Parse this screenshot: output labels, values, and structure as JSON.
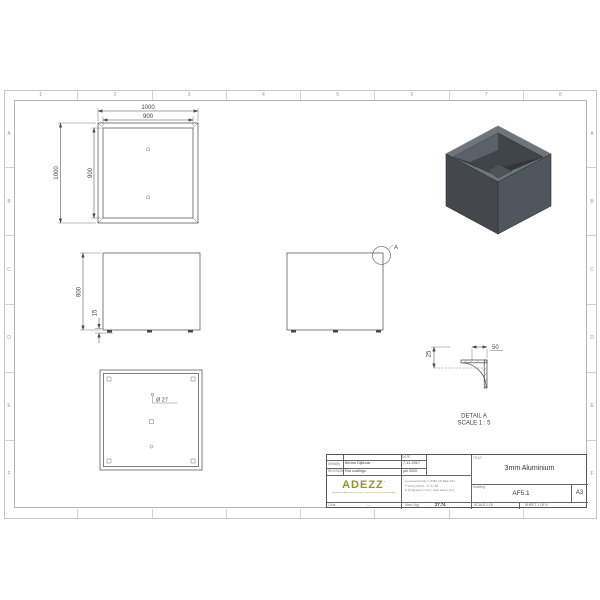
{
  "sheet": {
    "grid_columns": [
      "1",
      "2",
      "3",
      "4",
      "5",
      "6",
      "7",
      "8"
    ],
    "grid_rows": [
      "A",
      "B",
      "C",
      "D",
      "E",
      "F"
    ]
  },
  "views": {
    "top": {
      "dim_width_outer": "1000",
      "dim_width_inner": "900",
      "dim_height_outer": "1000",
      "dim_height_inner": "900"
    },
    "front": {
      "dim_height": "800",
      "dim_foot": "15"
    },
    "side": {
      "detail_label": "A"
    },
    "bottom": {
      "hole_dia": "Ø 27"
    },
    "detail": {
      "title": "DETAIL A",
      "scale": "SCALE 1 : 5",
      "dim_top": "50",
      "dim_side": "25"
    }
  },
  "titleblock": {
    "drawn_label": "DRAWN",
    "drawn_value": "Benno Dijkhuis",
    "revision_label": "REVISION",
    "revision_value": "Ral coatings",
    "date_label": "DATE",
    "drawn_date": "7-11-2017",
    "revision_date": "juli 2020",
    "title_label": "TITLE",
    "title_value": "3mm Aluminium",
    "drawing_label": "Drawing.",
    "drawing_number": "AF5.1",
    "paper_size": "A3",
    "color_label": "Color",
    "color_value": "---",
    "mass_label": "Mass (kg):",
    "mass_value": "27.74",
    "scale_text": "SCALE:1:15",
    "sheet_text": "SHEET 1 OF 6",
    "company": {
      "name": "ADEZZ",
      "mark": "’",
      "tagline": "METALEN MAATWERK PRODUCTEN VOOR PROFESSIONALS",
      "address_line1": "Leeuwerikstraat 4, 8483 AD Balk (NL)",
      "address_line2": "T 0031 (0)510 - 27 41 68",
      "address_line3": "E info@adezz.com / www.adezz.com"
    }
  },
  "colors": {
    "accent_olive": "#8f9133",
    "line": "#454545",
    "box_left_face": "#44484d",
    "box_right_face": "#50565d",
    "box_rim": "#6e747a",
    "box_interior": "#40454b"
  }
}
